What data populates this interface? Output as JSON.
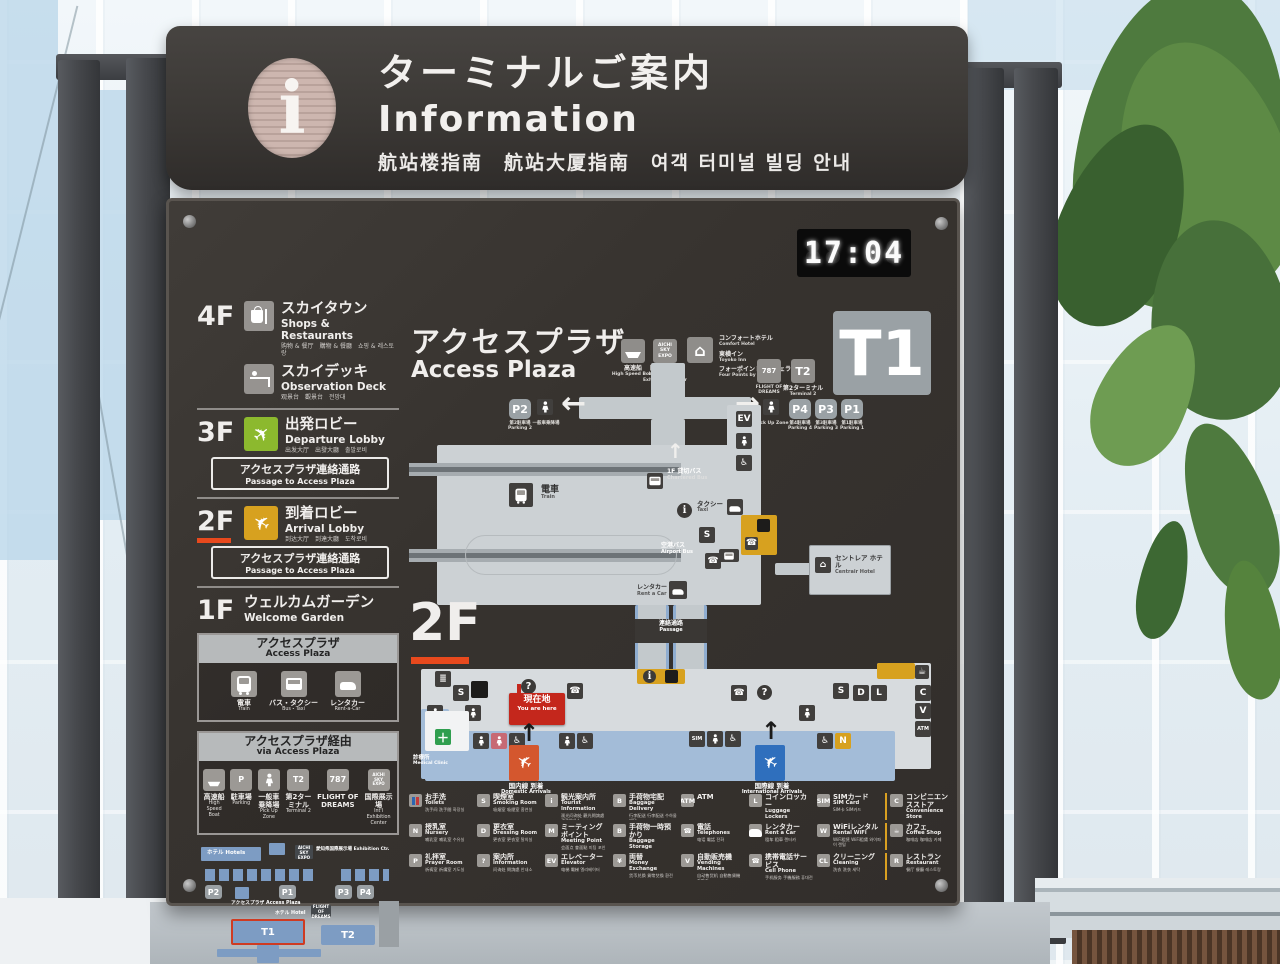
{
  "colors": {
    "board_bg": "#37332f",
    "accent_orange": "#e8491d",
    "departure_green": "#8cb92e",
    "arrival_amber": "#d7a11f",
    "map_building": "#ccd1d4",
    "map_blue_band": "#a3bcd8",
    "minimap_blue": "#7d9cc3",
    "orange_block": "#d7a11f",
    "here_red": "#c4271c",
    "domestic_red": "#d4572e",
    "international_blue": "#2f6fbd",
    "clinic_green": "#2f9e4f",
    "t1_badge_gray": "#9aa1a5",
    "legend_separator_yellow": "#d9a021"
  },
  "board": {
    "clock": "17:04",
    "t1_badge": "T1",
    "floor_label": "2F",
    "ghost": "88:88"
  },
  "header": {
    "title_jp": "ターミナルご案内",
    "title_en": "Information",
    "subtitle": "航站楼指南　航站大厦指南　여객 터미널 빌딩 안내"
  },
  "sidebar": {
    "floors": [
      {
        "floor": "4F",
        "items": [
          {
            "jp": "スカイタウン",
            "en": "Shops & Restaurants",
            "sub": "购物 & 餐厅　購物 & 餐廳　쇼핑 & 레스토랑"
          },
          {
            "jp": "スカイデッキ",
            "en": "Observation Deck",
            "sub": "观景台　觀景台　전망대"
          }
        ]
      },
      {
        "floor": "3F",
        "items": [
          {
            "jp": "出発ロビー",
            "en": "Departure Lobby",
            "sub": "出发大厅　出發大廳　출발로비"
          }
        ],
        "passage": {
          "jp": "アクセスプラザ連絡通路",
          "en": "Passage to Access Plaza"
        }
      },
      {
        "floor": "2F",
        "items": [
          {
            "jp": "到着ロビー",
            "en": "Arrival Lobby",
            "sub": "到达大厅　到達大廳　도착로비"
          }
        ],
        "passage": {
          "jp": "アクセスプラザ連絡通路",
          "en": "Passage to Access Plaza"
        }
      },
      {
        "floor": "1F",
        "items": [
          {
            "jp": "ウェルカムガーデン",
            "en": "Welcome Garden",
            "sub": ""
          }
        ]
      }
    ],
    "access_plaza_box": {
      "title_jp": "アクセスプラザ",
      "title_en": "Access Plaza",
      "items": [
        {
          "jp": "電車",
          "en": "Train",
          "ic": "train"
        },
        {
          "jp": "バス・タクシー",
          "en": "Bus・Taxi",
          "ic": "bus"
        },
        {
          "jp": "レンタカー",
          "en": "Rent-a-Car",
          "ic": "car"
        }
      ]
    },
    "via_box": {
      "title_jp": "アクセスプラザ経由",
      "title_en": "via Access Plaza",
      "items": [
        {
          "jp": "高速船",
          "en": "High Speed Boat",
          "ic": "boat"
        },
        {
          "jp": "駐車場",
          "en": "Parking",
          "ic": "parking"
        },
        {
          "jp": "一般車乗降場",
          "en": "Pick Up Zone",
          "ic": "walk"
        },
        {
          "jp": "第2ターミナル",
          "en": "Terminal 2",
          "ic": "t2"
        },
        {
          "jp": "FLIGHT OF DREAMS",
          "en": "",
          "ic": "787"
        },
        {
          "jp": "国際展示場",
          "en": "Int'l Exhibition Center",
          "ic": "expo"
        }
      ]
    },
    "minimap": {
      "hotels": "ホテル Hotels",
      "expo_badge": "AICHI SKY EXPO",
      "expo": "愛知県国際展示場 Exhibition Ctr.",
      "p1": "P1",
      "p2": "P2",
      "p3": "P3",
      "p4": "P4",
      "access_plaza": "アクセスプラザ Access Plaza",
      "hotel": "ホテル Hotel",
      "fod": "FLIGHT OF DREAMS",
      "t1": "T1",
      "t2": "T2"
    }
  },
  "map": {
    "title_jp": "アクセスプラザ",
    "title_en": "Access Plaza",
    "top": {
      "boat_jp": "高速船",
      "boat_en": "High Speed Boat",
      "expo_badge": "AICHI SKY EXPO",
      "expo_jp": "国際展示場",
      "expo_en": "International Exhibition Center",
      "hotels": [
        {
          "jp": "コンフォートホテル",
          "en": "Comfort Hotel"
        },
        {
          "jp": "東横イン",
          "en": "Toyoko Inn"
        },
        {
          "jp": "フォーポイントバイシェラトン",
          "en": "Four Points by Sheraton"
        }
      ],
      "fod_badge": "787",
      "fod": "FLIGHT OF DREAMS",
      "t2_badge": "T2",
      "t2_jp": "第2ターミナル",
      "t2_en": "Terminal 2"
    },
    "parking": {
      "p1": "P1",
      "p1_sub": "第1駐車場 Parking 1",
      "p2": "P2",
      "p2_sub": "第2駐車場 Parking 2",
      "p3": "P3",
      "p3_sub": "第3駐車場 Parking 3",
      "p4": "P4",
      "p4_sub": "第4駐車場 Parking 4",
      "pickup_jp": "一般車乗降場",
      "pickup_en": "Pick Up Zone"
    },
    "labels": {
      "train_jp": "電車",
      "train_en": "Train",
      "rentacar_jp": "レンタカー",
      "rentacar_en": "Rent a Car",
      "bus1f": "1F",
      "chartered_jp": "貸切バス",
      "chartered_en": "Chartered Bus",
      "taxi_jp": "タクシー",
      "taxi_en": "Taxi",
      "airportbus_jp": "空港バス",
      "airportbus_en": "Airport Bus",
      "hotel_jp": "セントレア ホテル",
      "hotel_en": "Centrair Hotel",
      "passage_jp": "連絡通路",
      "passage_en": "Passage",
      "here_jp": "現在地",
      "here_en": "You are here",
      "clinic_jp": "診療所",
      "clinic_en": "Medical Clinic",
      "domestic_jp": "国内線 到着",
      "domestic_en": "Domestic Arrivals",
      "intl_jp": "国際線 到着",
      "intl_en": "International Arrivals"
    }
  },
  "legend": {
    "rows": [
      [
        {
          "jp": "お手洗",
          "en": "Toilets",
          "sub": "洗手间 洗手間 화장실",
          "ic": "wc"
        },
        {
          "jp": "喫煙室",
          "en": "Smoking Room",
          "sub": "吸烟室 吸煙室 흡연실",
          "ic": "smoke"
        },
        {
          "jp": "観光案内所",
          "en": "Tourist Information",
          "sub": "观光问询处 觀光問詢處 관광안내소",
          "ic": "info"
        },
        {
          "jp": "手荷物宅配",
          "en": "Baggage Delivery",
          "sub": "行李配送 行李配送 수하물 배달",
          "ic": "bag"
        },
        {
          "jp": "ATM",
          "en": "",
          "sub": "",
          "ic": "atm"
        },
        {
          "jp": "コインロッカー",
          "en": "Luggage Lockers",
          "sub": "投币式寄物柜 投幣式寄物櫃 코인로커",
          "ic": "locker"
        },
        {
          "jp": "SIMカード",
          "en": "SIM Card",
          "sub": "SIM卡 SIM카드",
          "ic": "sim"
        },
        {
          "jp": "コンビニエンスストア",
          "en": "Convenience Store",
          "sub": "便利店 便利商店 편의점",
          "ic": "store"
        }
      ],
      [
        {
          "jp": "授乳室",
          "en": "Nursery",
          "sub": "哺乳室 哺乳室 수유실",
          "ic": "nursery"
        },
        {
          "jp": "更衣室",
          "en": "Dressing Room",
          "sub": "更衣室 更衣室 탈의실",
          "ic": "dress"
        },
        {
          "jp": "ミーティングポイント",
          "en": "Meeting Point",
          "sub": "会面点 會面點 미팅 포인트",
          "ic": "meet"
        },
        {
          "jp": "手荷物一時預かり",
          "en": "Baggage Storage",
          "sub": "行李寄存 行李寄存 수하물 보관",
          "ic": "storage"
        },
        {
          "jp": "電話",
          "en": "Telephones",
          "sub": "电话 電話 전화",
          "ic": "tel"
        },
        {
          "jp": "レンタカー",
          "en": "Rent a Car",
          "sub": "租车 租車 렌터카",
          "ic": "car"
        },
        {
          "jp": "WiFiレンタル",
          "en": "Rental WiFi",
          "sub": "WiFi租赁 WiFi租賃 와이파이 렌털",
          "ic": "wifi"
        },
        {
          "jp": "カフェ",
          "en": "Coffee Shop",
          "sub": "咖啡店 咖啡店 카페",
          "ic": "coffee"
        }
      ],
      [
        {
          "jp": "礼拝室",
          "en": "Prayer Room",
          "sub": "祈祷室 祈禱室 기도실",
          "ic": "pray"
        },
        {
          "jp": "案内所",
          "en": "Information",
          "sub": "问询处 問詢處 안내소",
          "ic": "question"
        },
        {
          "jp": "エレベーター",
          "en": "Elevator",
          "sub": "电梯 電梯 엘리베이터",
          "ic": "elev"
        },
        {
          "jp": "両替",
          "en": "Money Exchange",
          "sub": "货币兑换 貨幣兌換 환전",
          "ic": "exchange"
        },
        {
          "jp": "自動販売機",
          "en": "Vending Machines",
          "sub": "自动售货机 自動售貨機 자판기",
          "ic": "vending"
        },
        {
          "jp": "携帯電話サービス",
          "en": "Cell Phone",
          "sub": "手机服务 手機服務 휴대전화 서비스",
          "ic": "phone"
        },
        {
          "jp": "クリーニング",
          "en": "Cleaning",
          "sub": "洗衣 洗衣 세탁",
          "ic": "clean"
        },
        {
          "jp": "レストラン",
          "en": "Restaurant",
          "sub": "餐厅 餐廳 레스토랑",
          "ic": "rest"
        }
      ]
    ]
  }
}
